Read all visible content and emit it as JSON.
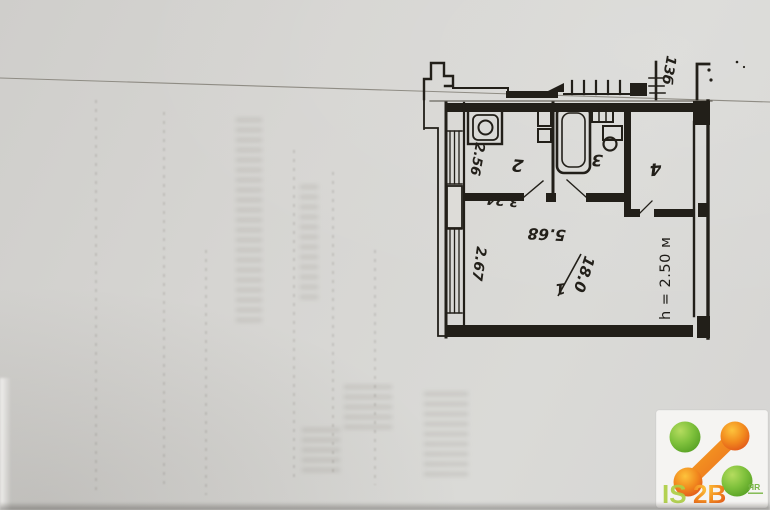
{
  "paper": {
    "base_color": "#d7d6d3",
    "ink_color": "#221f19",
    "pencil_line_color": "#8f8c84"
  },
  "plan": {
    "apartment_note": "13б",
    "ceiling_height": "h = 2.50 м",
    "rooms": [
      {
        "number": "1",
        "area": "18.0"
      },
      {
        "number": "2"
      },
      {
        "number": "3"
      },
      {
        "number": "4"
      }
    ],
    "dimensions": {
      "kitchen_width": "2.56",
      "kitchen_depth": "3.24",
      "room1_width": "5.68",
      "balcony_depth": "2.67"
    },
    "fixtures": [
      "stove",
      "sink",
      "bathtub",
      "washbasin",
      "toilet",
      "window",
      "balcony"
    ]
  },
  "logo": {
    "part1": "IS",
    "part2": "2B",
    "superscript": "ЯR",
    "green": "#8cc63f",
    "light_green": "#aecf45",
    "orange": "#f28b1e",
    "deep_orange": "#e8671c"
  }
}
